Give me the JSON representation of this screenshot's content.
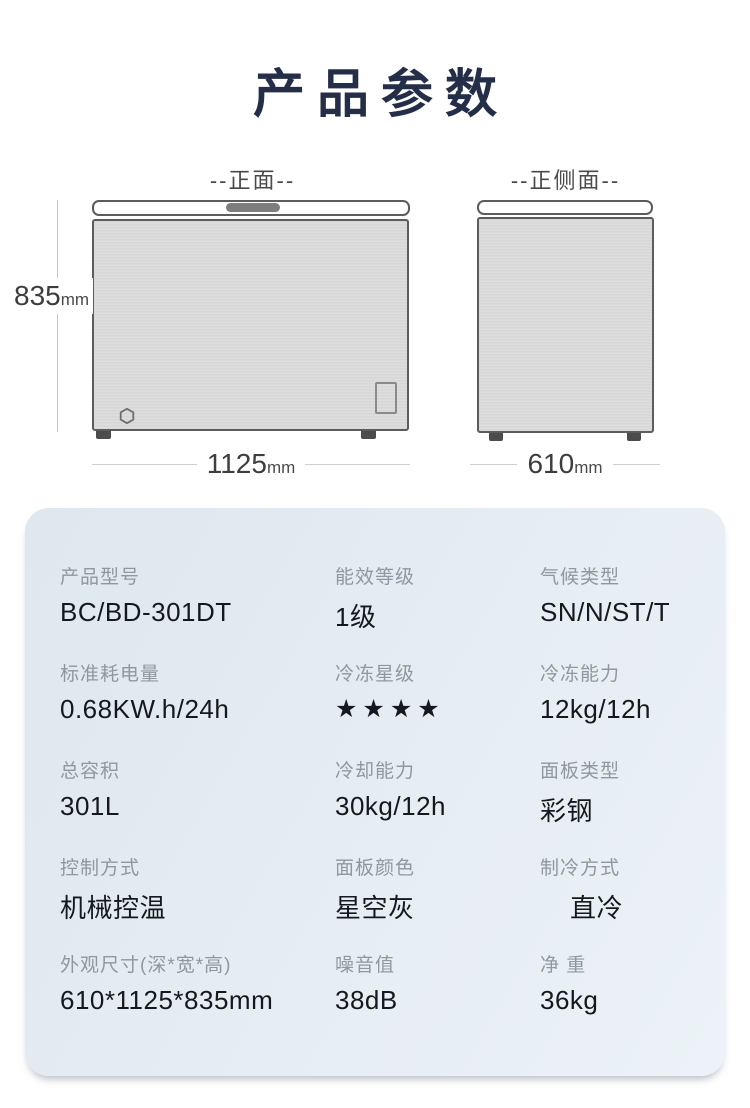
{
  "page": {
    "title": "产品参数"
  },
  "diagram": {
    "front": {
      "label": "--正面--",
      "height_value": "835",
      "height_unit": "mm",
      "width_value": "1125",
      "width_unit": "mm"
    },
    "side": {
      "label": "--正侧面--",
      "width_value": "610",
      "width_unit": "mm"
    }
  },
  "colors": {
    "title": "#252e49",
    "card_background": "#e4ebf2",
    "cabinet_fill": "#dadada",
    "star": "#000000"
  },
  "specs": {
    "rows": [
      {
        "cells": [
          {
            "label": "产品型号",
            "value": "BC/BD-301DT"
          },
          {
            "label": "能效等级",
            "value": "1级"
          },
          {
            "label": "气候类型",
            "value": "SN/N/ST/T"
          }
        ]
      },
      {
        "cells": [
          {
            "label": "标准耗电量",
            "value": "0.68KW.h/24h"
          },
          {
            "label": "冷冻星级",
            "value": "★★★★"
          },
          {
            "label": "冷冻能力",
            "value": "12kg/12h"
          }
        ]
      },
      {
        "cells": [
          {
            "label": "总容积",
            "value": "301L"
          },
          {
            "label": "冷却能力",
            "value": "30kg/12h"
          },
          {
            "label": "面板类型",
            "value": "彩钢"
          }
        ]
      },
      {
        "cells": [
          {
            "label": "控制方式",
            "value": "机械控温"
          },
          {
            "label": "面板颜色",
            "value": "星空灰"
          },
          {
            "label": "制冷方式",
            "value": "直冷"
          }
        ]
      },
      {
        "cells": [
          {
            "label": "外观尺寸(深*宽*高)",
            "value": "610*1125*835mm"
          },
          {
            "label": "噪音值",
            "value": "38dB"
          },
          {
            "label": "净 重",
            "value": "36kg"
          }
        ]
      }
    ]
  }
}
